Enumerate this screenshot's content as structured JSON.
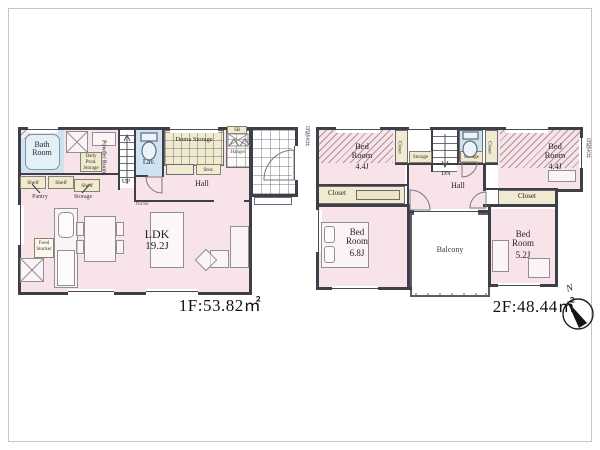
{
  "floor1": {
    "area_label": "1F:53.82㎡",
    "bath": "Bath Room",
    "powder": "Powder Room",
    "daily_storage": "Daily Prod. Storage",
    "shelf": "Shelf",
    "pantry": "Pantry",
    "storage": "Storage",
    "stairs_up": "UP",
    "lav": "Lav.",
    "doma_storage": "Doma Storage",
    "stor": "Stor.",
    "shoe_box": "SB",
    "hanger": "Hanger",
    "hall": "Hall",
    "niche": "Niche",
    "ldk_name": "LDK",
    "ldk_size": "19.2J",
    "food_stocker": "Food Stocker"
  },
  "floor2": {
    "area_label": "2F:48.44㎡",
    "bed_name": "Bed Room",
    "bed_left_size": "4.4J",
    "bed_right_size": "4.4J",
    "bed_68_size": "6.8J",
    "bed_52_size": "5.2J",
    "closet": "Closet",
    "storage": "Storage",
    "stairs_dn": "DN",
    "hall": "Hall",
    "balcony": "Balcony",
    "sloped_note": "勾配天井"
  },
  "compass": {
    "north": "N"
  },
  "colors": {
    "room_pink": "#f8e4e8",
    "water_blue": "#cde3f0",
    "storage_cream": "#f0ead0",
    "wall": "#3f3f49"
  }
}
